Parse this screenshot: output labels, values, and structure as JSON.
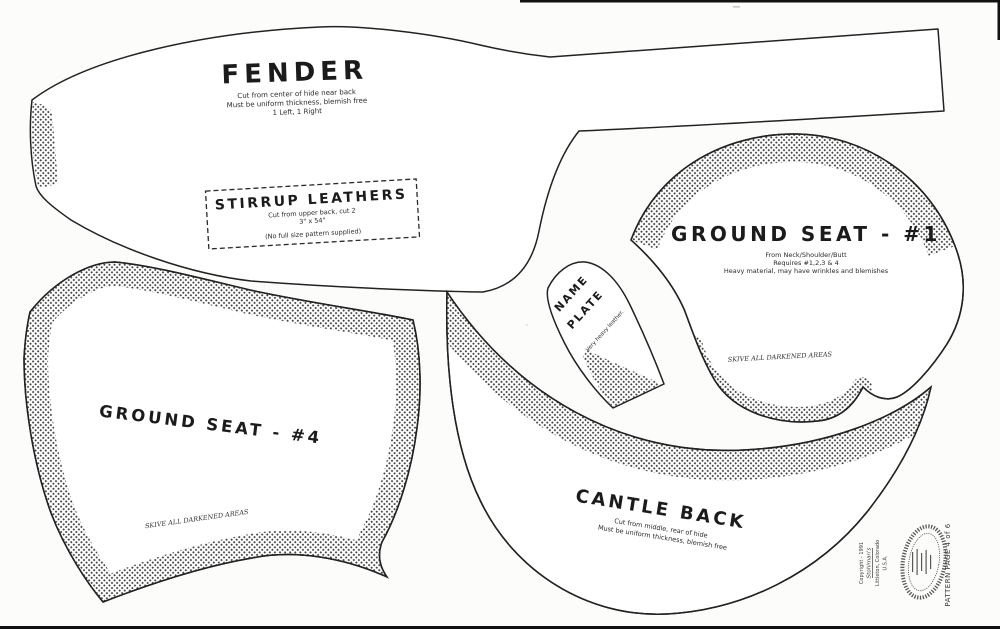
{
  "colors": {
    "ink": "#222222",
    "paper": "#fcfcfa",
    "halftone": "#454545"
  },
  "pieces": {
    "fender": {
      "title": "FENDER",
      "note1": "Cut from center of hide near back",
      "note2": "Must be uniform thickness, blemish free",
      "note3": "1 Left, 1 Right"
    },
    "stirrup_leathers": {
      "title": "STIRRUP LEATHERS",
      "note1": "Cut from upper back, cut 2",
      "note2": "3\" x 54\"",
      "note3": "(No full size pattern supplied)"
    },
    "ground_seat_1": {
      "title": "GROUND SEAT - #1",
      "note1": "From Neck/Shoulder/Butt",
      "note2": "Requires #1,2,3 & 4",
      "note3": "Heavy material, may have wrinkles and blemishes",
      "skive": "SKIVE ALL DARKENED AREAS"
    },
    "name_plate": {
      "title1": "NAME",
      "title2": "PLATE",
      "note": "Very heavy leather."
    },
    "ground_seat_4": {
      "title": "GROUND SEAT - #4",
      "skive": "SKIVE ALL DARKENED AREAS"
    },
    "cantle_back": {
      "title": "CANTLE BACK",
      "note1": "Cut from middle, rear of hide",
      "note2": "Must be uniform thickness, blemish free"
    }
  },
  "footer": {
    "copyright_line1": "Copyright - 1991",
    "copyright_line2": "Stohlman's",
    "copyright_line3": "Littleton, Colorado",
    "copyright_line4": "U.S.A.",
    "page_label": "PATTERN PAGE 4 of 6"
  }
}
